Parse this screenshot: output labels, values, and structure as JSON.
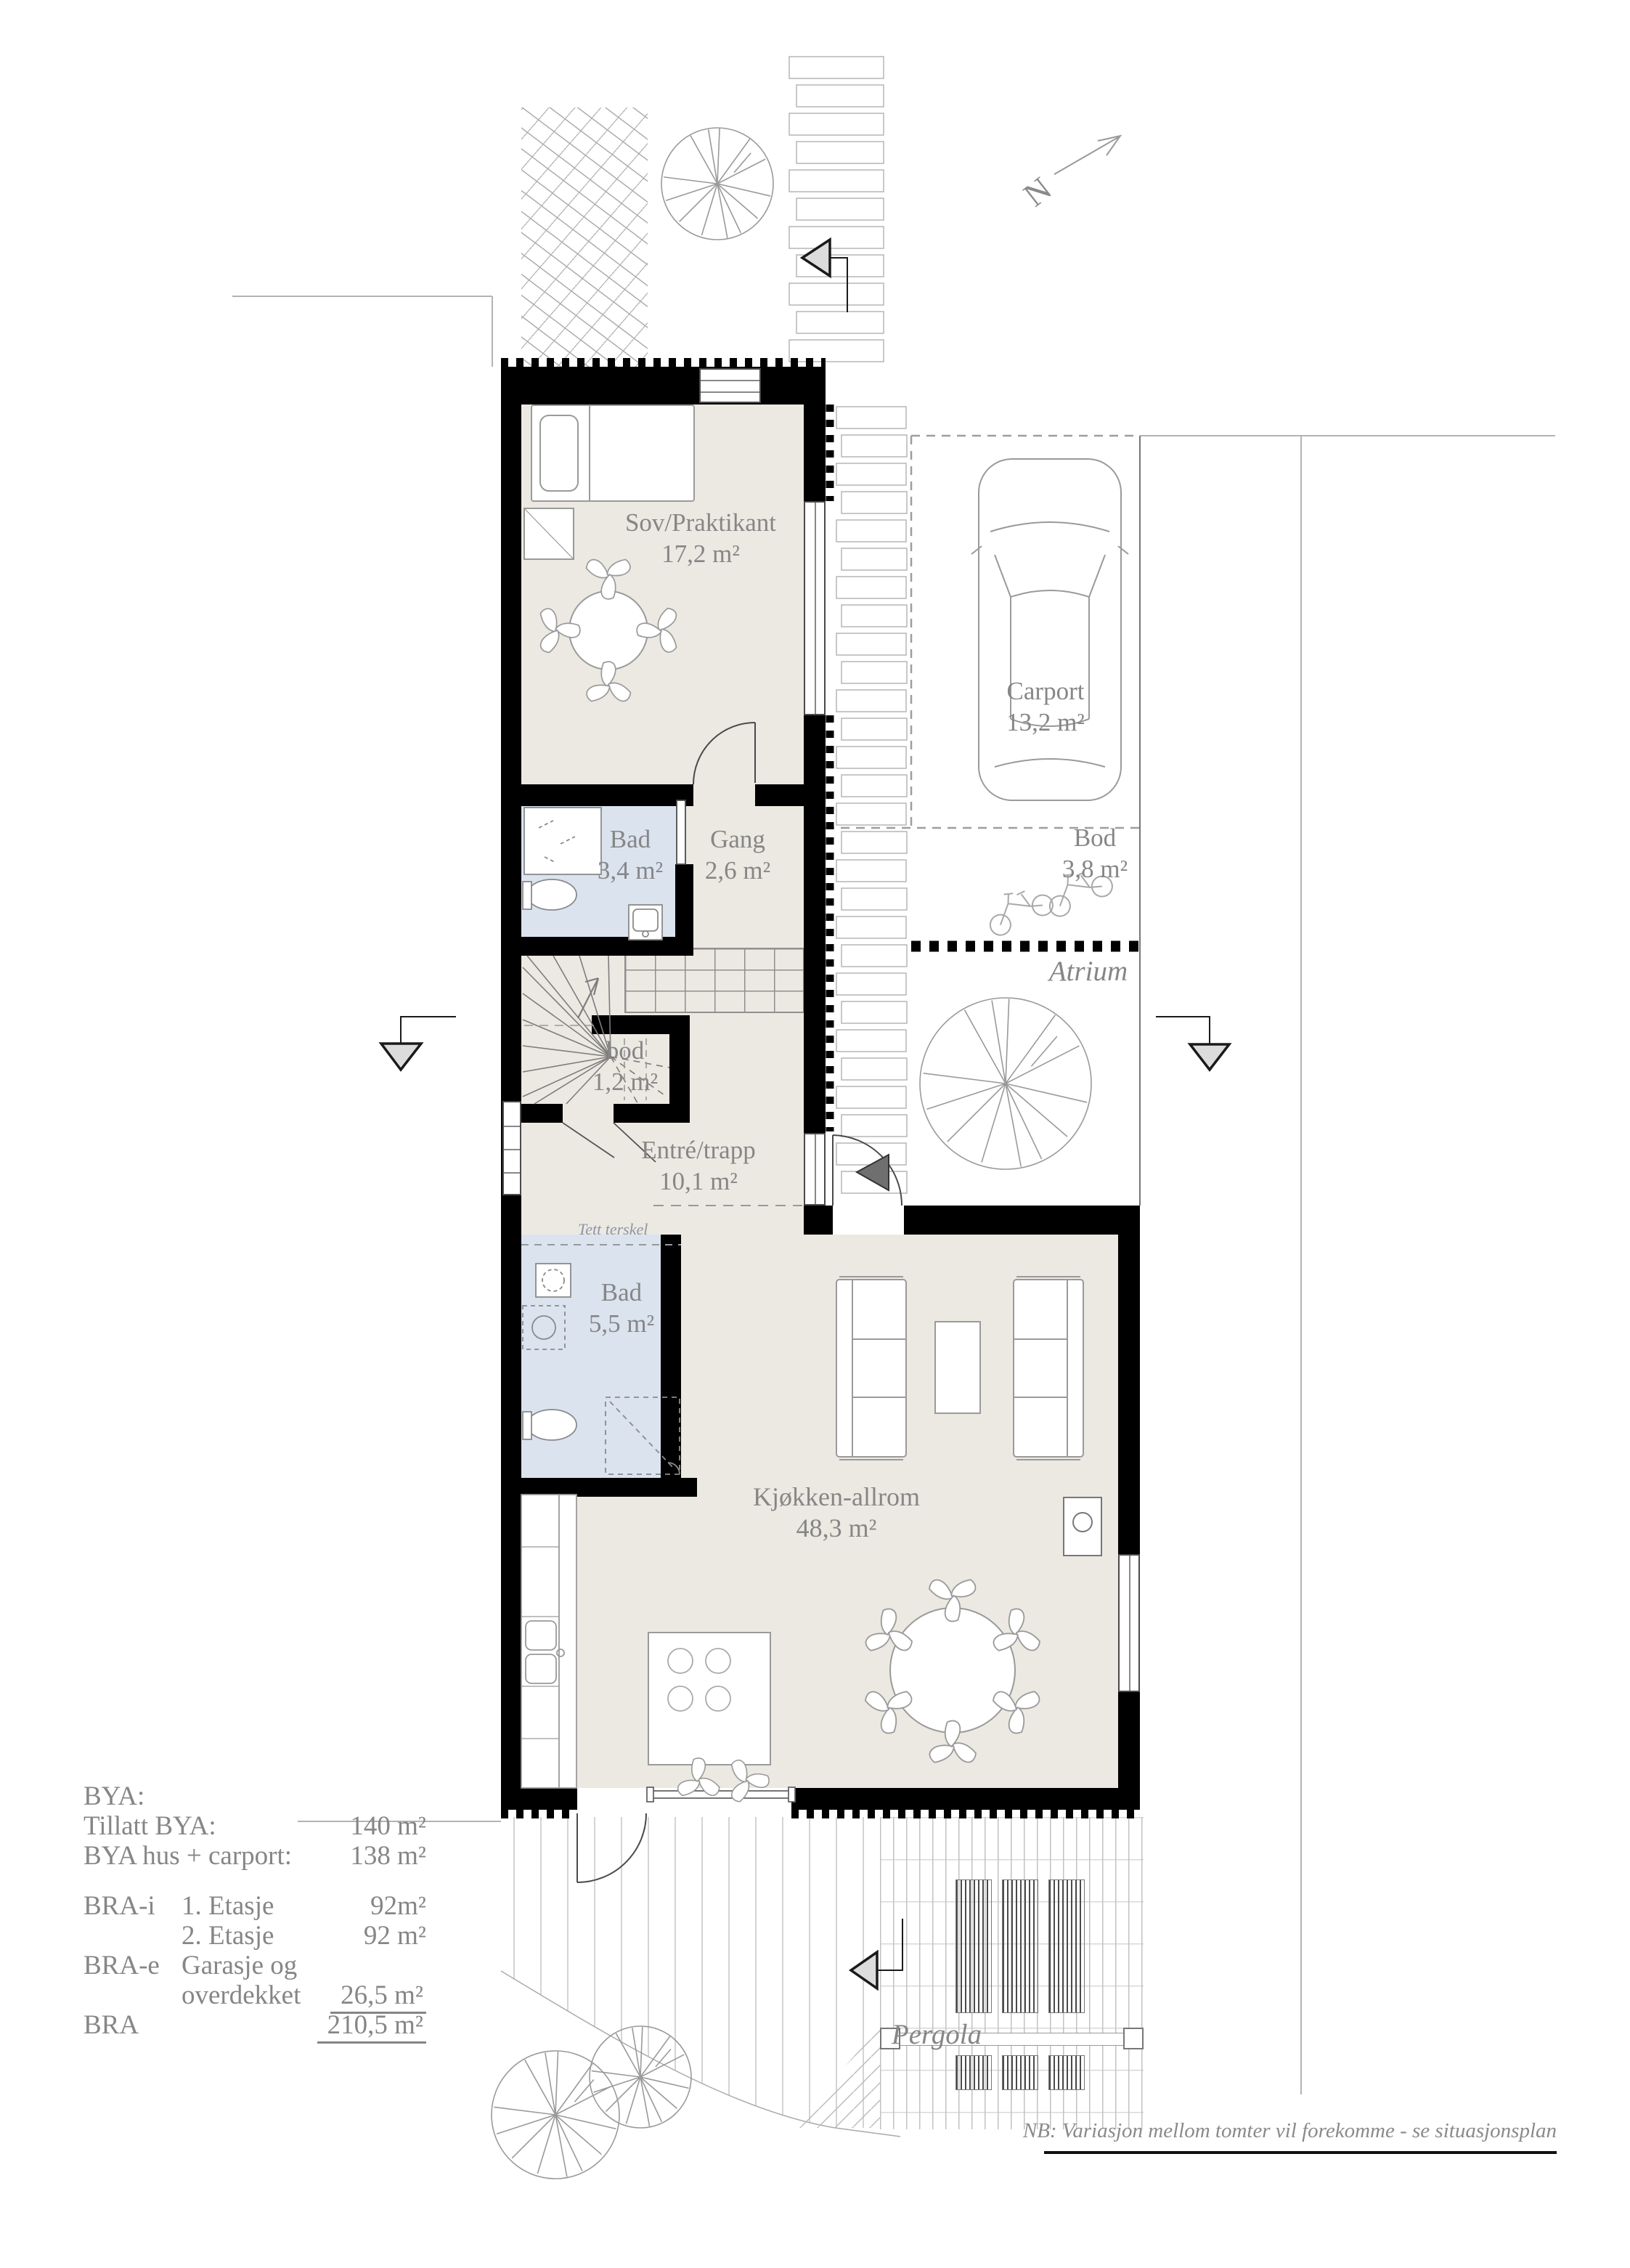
{
  "colors": {
    "wall": "#000000",
    "floor": "#ece9e2",
    "wet_room": "#dbe3ef",
    "label_text": "#868686",
    "line": "#9a9a9a",
    "arrow_fill": "#dcdcdc"
  },
  "north": {
    "label": "N"
  },
  "rooms": [
    {
      "name": "Sov/Praktikant",
      "area": "17,2 m²"
    },
    {
      "name": "Bad",
      "area": "3,4 m²"
    },
    {
      "name": "Gang",
      "area": "2,6 m²"
    },
    {
      "name": "bod",
      "area": "1,2 m²"
    },
    {
      "name": "Entré/trapp",
      "area": "10,1 m²"
    },
    {
      "name": "Bad",
      "area": "5,5 m²"
    },
    {
      "name": "Kjøkken-allrom",
      "area": "48,3 m²"
    },
    {
      "name": "Carport",
      "area": "13,2 m²"
    },
    {
      "name": "Bod",
      "area": "3,8 m²"
    },
    {
      "name": "Atrium",
      "area": ""
    },
    {
      "name": "Pergola",
      "area": ""
    }
  ],
  "annotations": {
    "threshold": "Tett terskel",
    "footnote": "NB: Variasjon mellom tomter vil forekomme - se situasjonsplan"
  },
  "area_table": {
    "rows": [
      {
        "c1": "BYA:",
        "c2": "",
        "c3": ""
      },
      {
        "c1": "Tillatt BYA:",
        "c2": "",
        "c3": "140 m²"
      },
      {
        "c1": "BYA hus + carport:",
        "c2": "",
        "c3": "138 m²"
      },
      {
        "c1": "BRA-i",
        "c2": "1. Etasje",
        "c3": "92m²"
      },
      {
        "c1": "",
        "c2": "2. Etasje",
        "c3": "92 m²"
      },
      {
        "c1": "BRA-e",
        "c2": "Garasje og",
        "c3": ""
      },
      {
        "c1": "",
        "c2": "overdekket",
        "c3": "26,5 m²"
      },
      {
        "c1": "BRA",
        "c2": "",
        "c3": "210,5 m²"
      }
    ]
  }
}
